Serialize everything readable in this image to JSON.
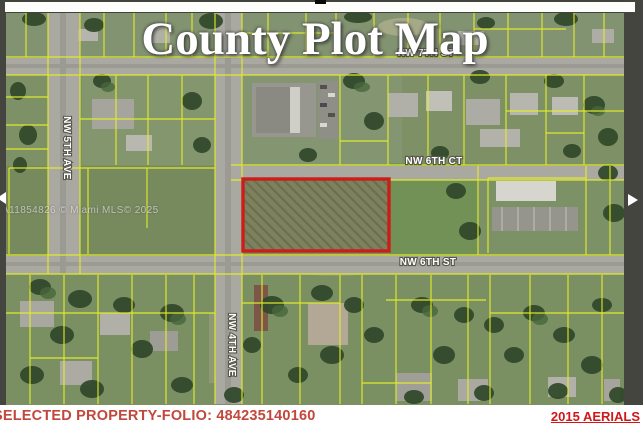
{
  "header": {
    "title": "County Plot Map"
  },
  "map": {
    "watermark": "A11854826 © Miami MLS© 2025",
    "street_labels": {
      "nw_7th_st": "NW 7TH ST",
      "nw_6th_ct": "NW 6TH CT",
      "nw_6th_st": "NW 6TH ST",
      "nw_5th_ave": "NW 5TH AVE",
      "nw_4th_ave": "NW 4TH AVE"
    },
    "colors": {
      "parcel_line": "#e4ee28",
      "selected_parcel_outline": "#cd1d1a",
      "road": "#a9a9a1",
      "grass": "#7d9066"
    }
  },
  "footer": {
    "selected_property_label": "SELECTED PROPERTY-FOLIO: 484235140160",
    "aerials_label": "2015 AERIALS",
    "folio_text_color": "#c2473c",
    "aerials_text_color": "#d01818"
  }
}
